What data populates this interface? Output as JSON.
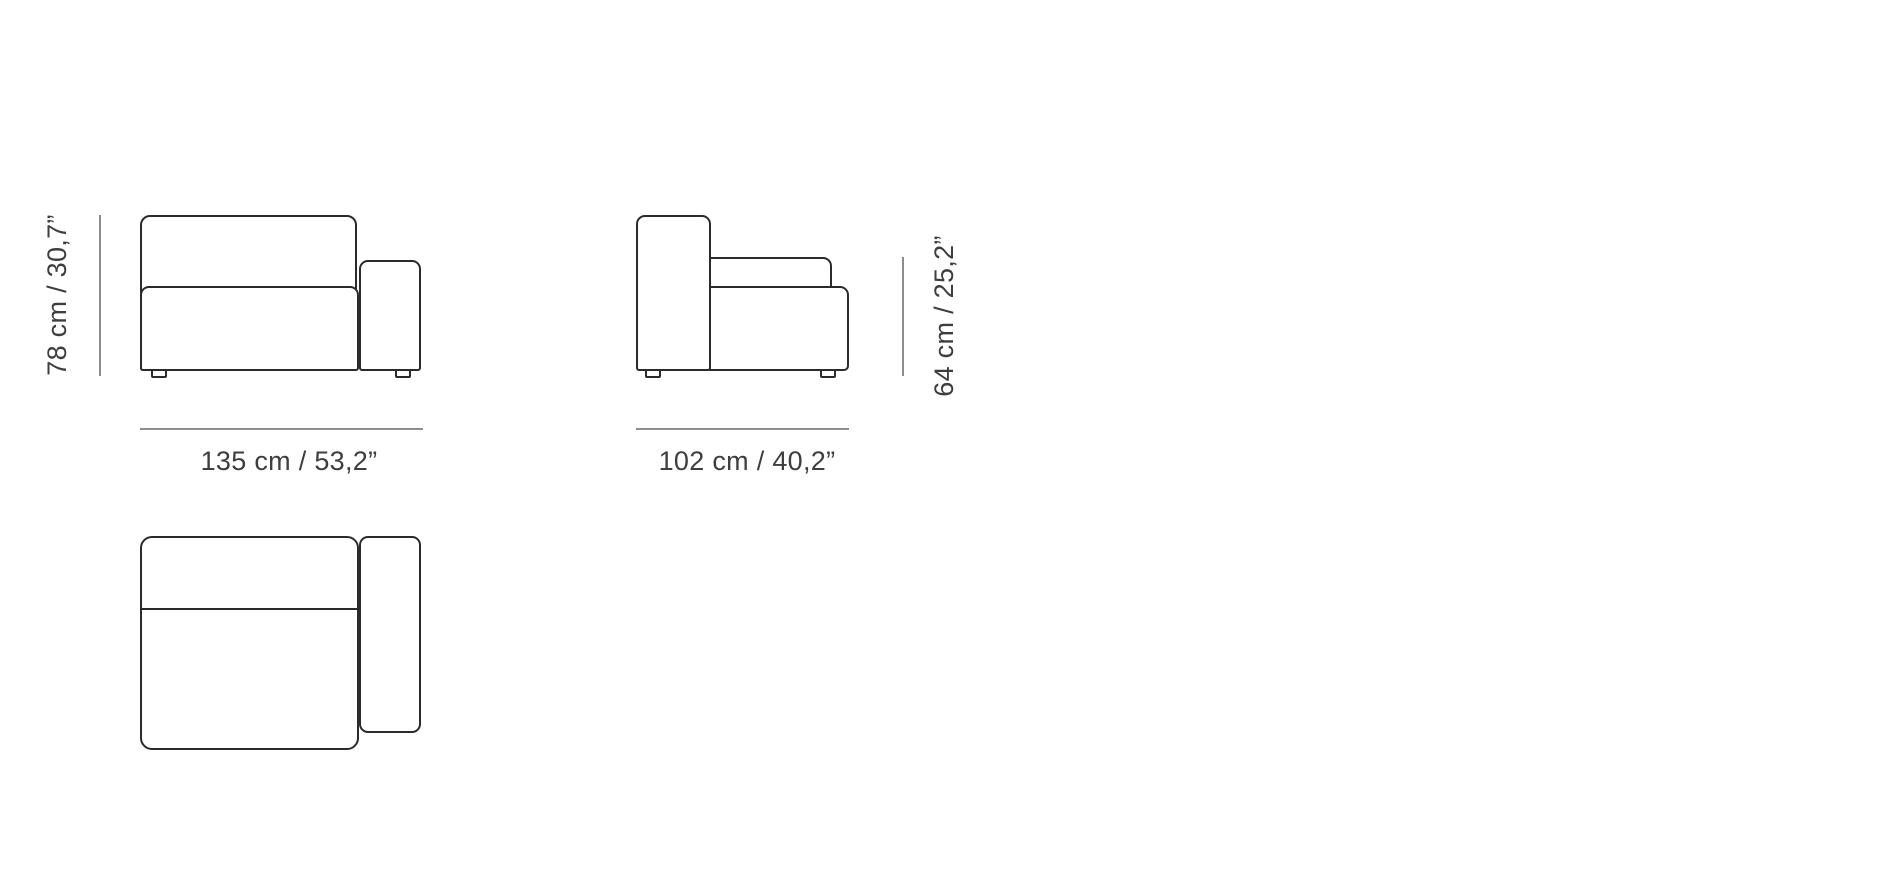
{
  "canvas": {
    "width": 1890,
    "height": 886,
    "background": "#ffffff"
  },
  "style": {
    "outline_color": "#2b2b2b",
    "dimension_line_color": "#8d8d8d",
    "label_color": "#3e3e3e"
  },
  "diagram": {
    "type": "furniture-dimension-drawing",
    "subject": "sofa module with right armrest"
  },
  "views": {
    "front": {
      "name": "front view",
      "height_dimension": "78 cm / 30,7”",
      "width_dimension": "135 cm / 53,2”"
    },
    "side": {
      "name": "side view",
      "width_dimension": "102 cm / 40,2”",
      "height_dimension": "64 cm / 25,2”"
    },
    "top": {
      "name": "top view"
    }
  }
}
